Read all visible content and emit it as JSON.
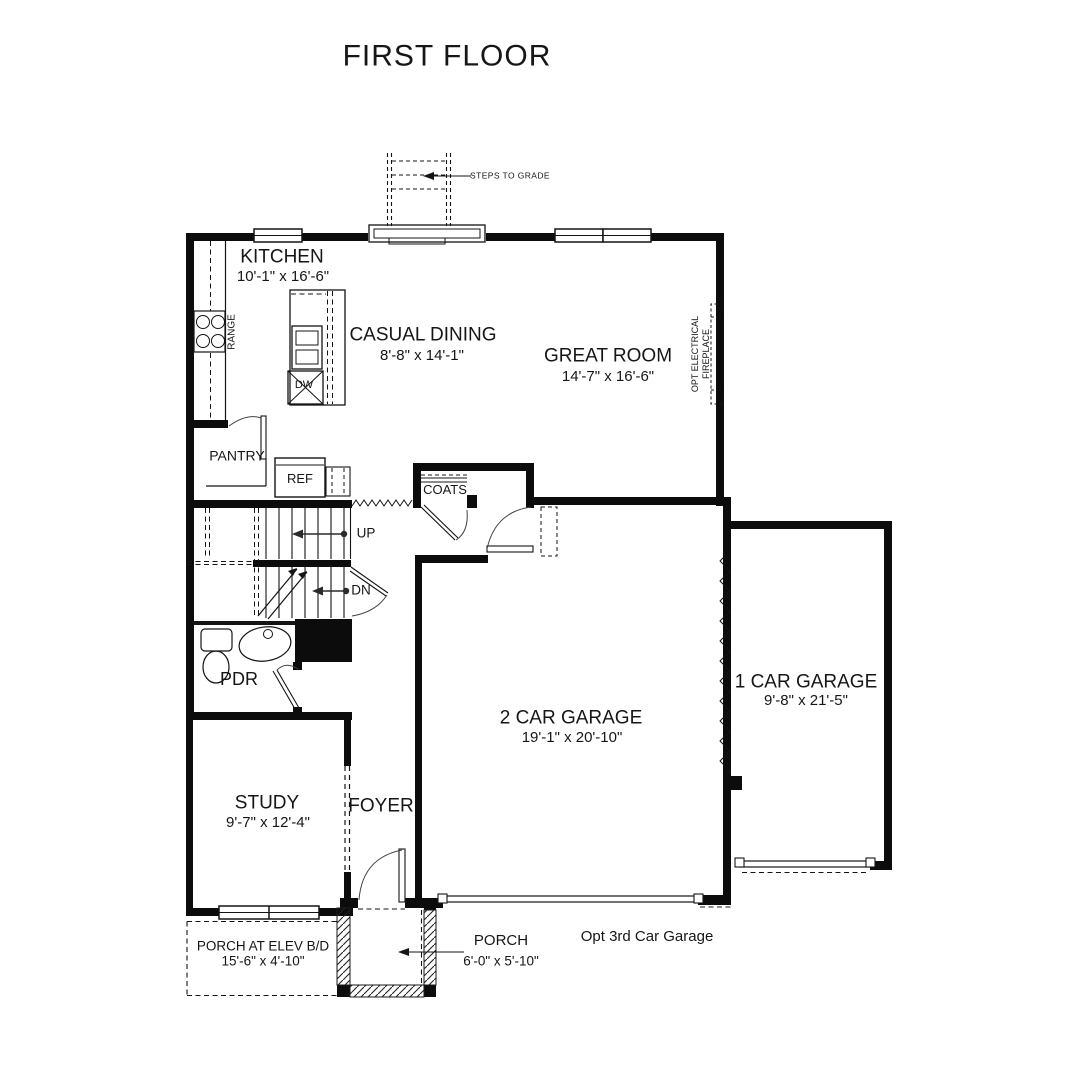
{
  "title": "FIRST FLOOR",
  "rooms": {
    "kitchen": {
      "name": "KITCHEN",
      "dims": "10'-1\" x 16'-6\""
    },
    "casual_dining": {
      "name": "CASUAL DINING",
      "dims": "8'-8\" x 14'-1\""
    },
    "great_room": {
      "name": "GREAT ROOM",
      "dims": "14'-7\" x 16'-6\""
    },
    "study": {
      "name": "STUDY",
      "dims": "9'-7\" x 12'-4\""
    },
    "foyer": {
      "name": "FOYER"
    },
    "pdr": {
      "name": "PDR"
    },
    "pantry": {
      "name": "PANTRY"
    },
    "garage_2car": {
      "name": "2 CAR GARAGE",
      "dims": "19'-1\" x 20'-10\""
    },
    "garage_1car": {
      "name": "1 CAR GARAGE",
      "dims": "9'-8\" x 21'-5\""
    },
    "porch": {
      "name": "PORCH",
      "dims": "6'-0\" x 5'-10\""
    },
    "porch_elev": {
      "name": "PORCH AT ELEV B/D",
      "dims": "15'-6\" x 4'-10\""
    }
  },
  "labels": {
    "steps_to_grade": "STEPS TO GRADE",
    "opt_3rd_car_garage": "Opt 3rd Car Garage",
    "fireplace_line1": "OPT ELECTRICAL",
    "fireplace_line2": "FIREPLACE",
    "up": "UP",
    "dn": "DN",
    "range": "RANGE",
    "dw": "DW",
    "ref": "REF",
    "coats": "COATS"
  },
  "colors": {
    "line": "#141414",
    "background": "#ffffff"
  }
}
